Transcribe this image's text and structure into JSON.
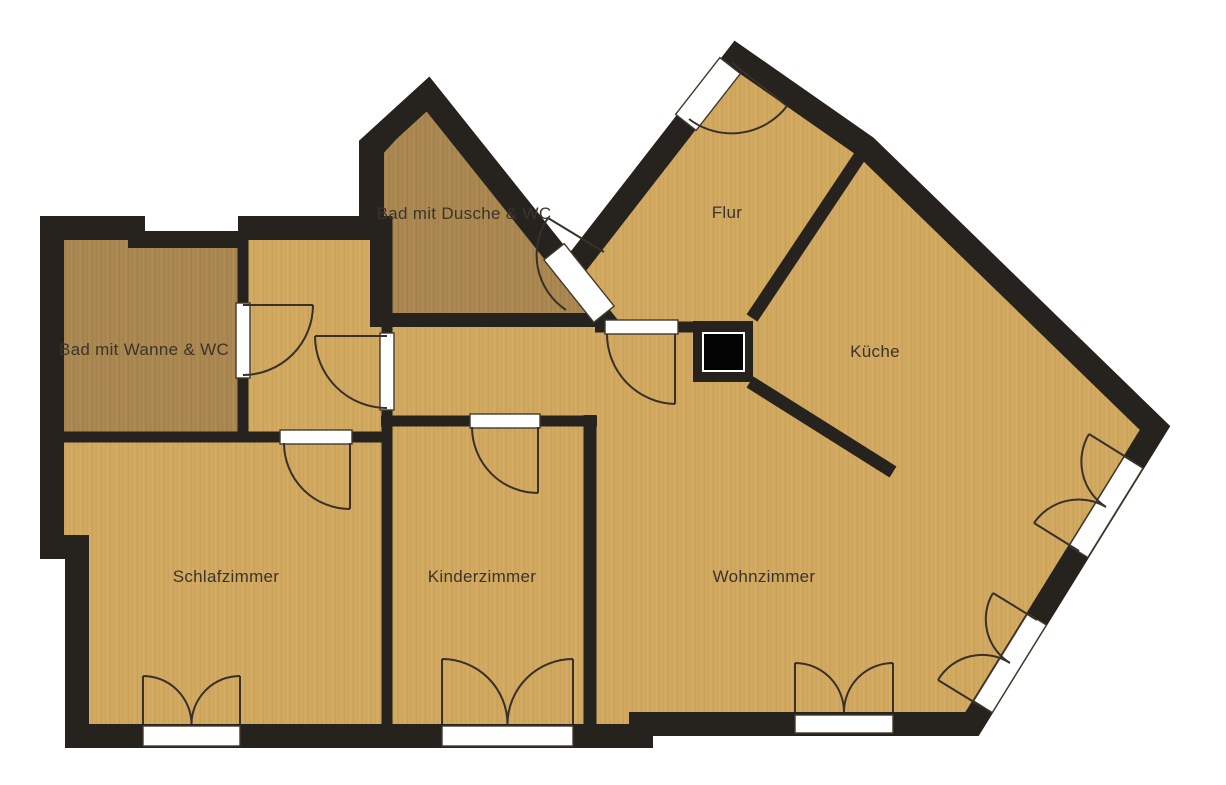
{
  "colors": {
    "background": "#ffffff",
    "wall": "#26221d",
    "floor_light": "#d2a960",
    "floor_dark": "#ab8852",
    "opening_white": "#ffffff",
    "swing_line": "#38302a",
    "label_text": "#3b342b",
    "shaft_fill": "#030303"
  },
  "rooms": [
    {
      "label": "Bad mit Wanne & WC",
      "floor": "dark"
    },
    {
      "label": "Bad mit Dusche & WC",
      "floor": "dark"
    },
    {
      "label": "Flur",
      "floor": "light"
    },
    {
      "label": "Küche",
      "floor": "light"
    },
    {
      "label": "Schlafzimmer",
      "floor": "light"
    },
    {
      "label": "Kinderzimmer",
      "floor": "light"
    },
    {
      "label": "Wohnzimmer",
      "floor": "light"
    }
  ],
  "features": {
    "single_door_swings": 7,
    "double_leaf_windows": 5,
    "entrance_door": 1,
    "shaft_pillar": 1
  }
}
